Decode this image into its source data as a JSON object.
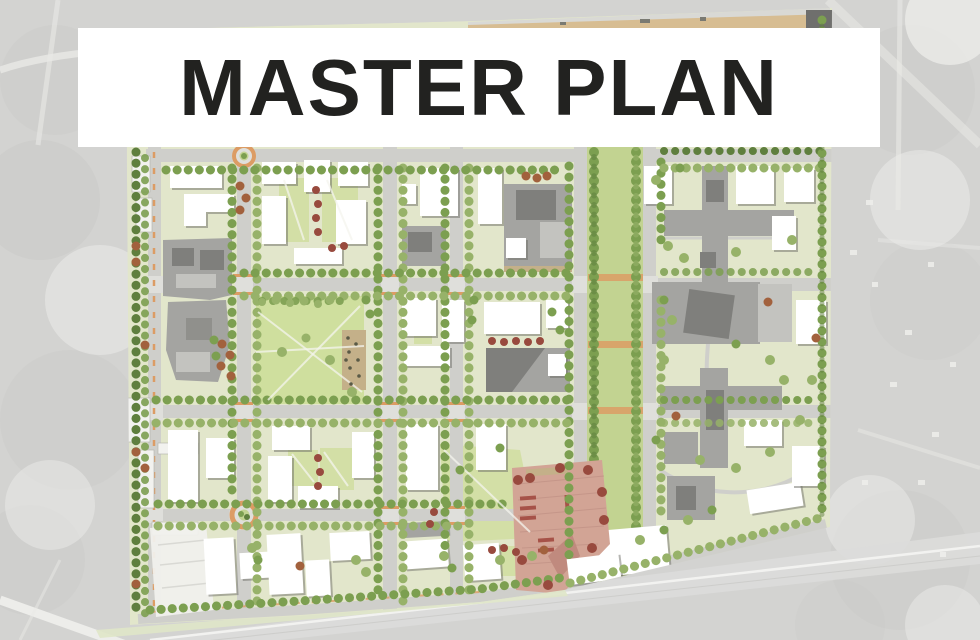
{
  "banner": {
    "title": "MASTER PLAN"
  },
  "colors": {
    "aerial_base": "#d3d3d1",
    "banner_bg": "#ffffff",
    "title_color": "#222220",
    "plan_base": "#e2e6cb",
    "lawn": "#cfdf9e",
    "mall_green": "#c2d391",
    "courtyard": "#d3dfa6",
    "road": "#cfcfcb",
    "intersection": "#dfdfdb",
    "road_accent": "#dc9c64",
    "tree_green": "#7c9f50",
    "tree_green_light": "#97b269",
    "tree_green_dark": "#5f7f3e",
    "tree_autumn": "#a2613d",
    "tree_red": "#984a3e",
    "building_white": "#ffffff",
    "building_gray": "#a4a4a1",
    "building_gray_dark": "#7f7f7c",
    "plaza": "#d2a495",
    "tan": "#c4b089",
    "parking": "#f2f2ef"
  }
}
